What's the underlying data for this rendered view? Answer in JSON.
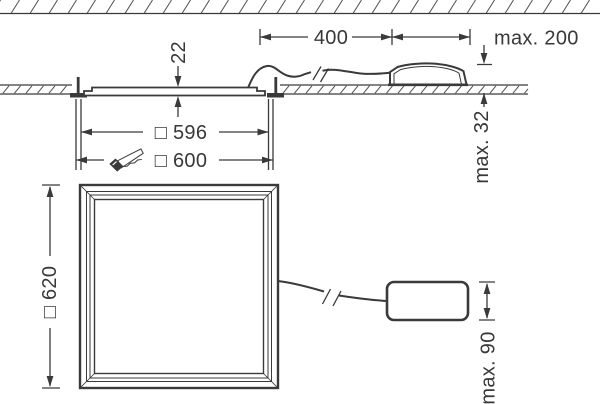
{
  "dims": {
    "recess_depth": "22",
    "cable_run": "400",
    "driver_distance": "max. 200",
    "driver_height": "max. 32",
    "panel_size": "□ 596",
    "cutout_size": "□ 600",
    "panel_outer": "□ 620",
    "driver_length": "max. 90"
  },
  "icons": {
    "saw": "handsaw-icon"
  },
  "colors": {
    "line": "#3a3a3a",
    "hatch": "#4f4f4f",
    "text": "#383838",
    "background": "#ffffff"
  }
}
